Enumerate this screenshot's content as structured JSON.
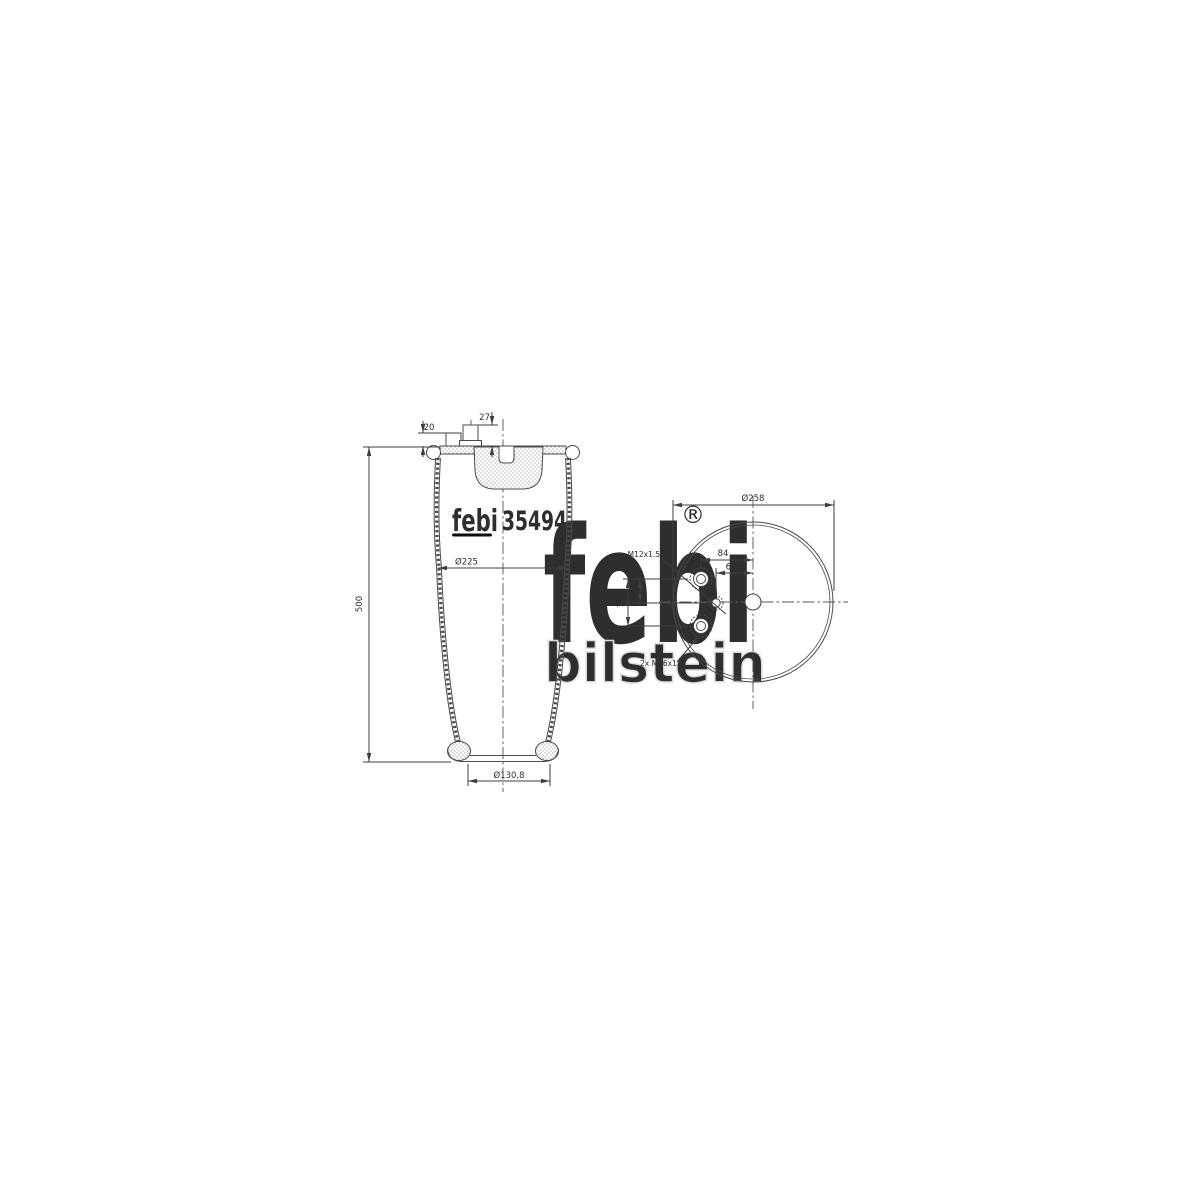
{
  "page": {
    "background": "#ffffff"
  },
  "colors": {
    "line": "#3f3f3f",
    "dim_text": "#2e2e2e",
    "watermark_gray": "#e8e8e8",
    "brand_black": "#0d0d0d"
  },
  "brand": {
    "logo_text": "febi",
    "part_number": "35494"
  },
  "watermark": {
    "script": "febi",
    "sub": "bilstein",
    "registered": "®"
  },
  "side_view": {
    "dim_stud_height_left": "20",
    "dim_stud_height_right": "27",
    "dim_body_diameter": "Ø225",
    "dim_overall_height": "500",
    "dim_piston_diameter": "Ø130,8"
  },
  "top_view": {
    "dim_plate_diameter": "Ø258",
    "dim_stud_offset_x": "84",
    "dim_port_offset_x": "60",
    "dim_stud_offset_y_half": "35",
    "dim_stud_spacing_y": "70",
    "thread_center": "M12x1.5",
    "thread_studs": "2x M16x1.5"
  }
}
